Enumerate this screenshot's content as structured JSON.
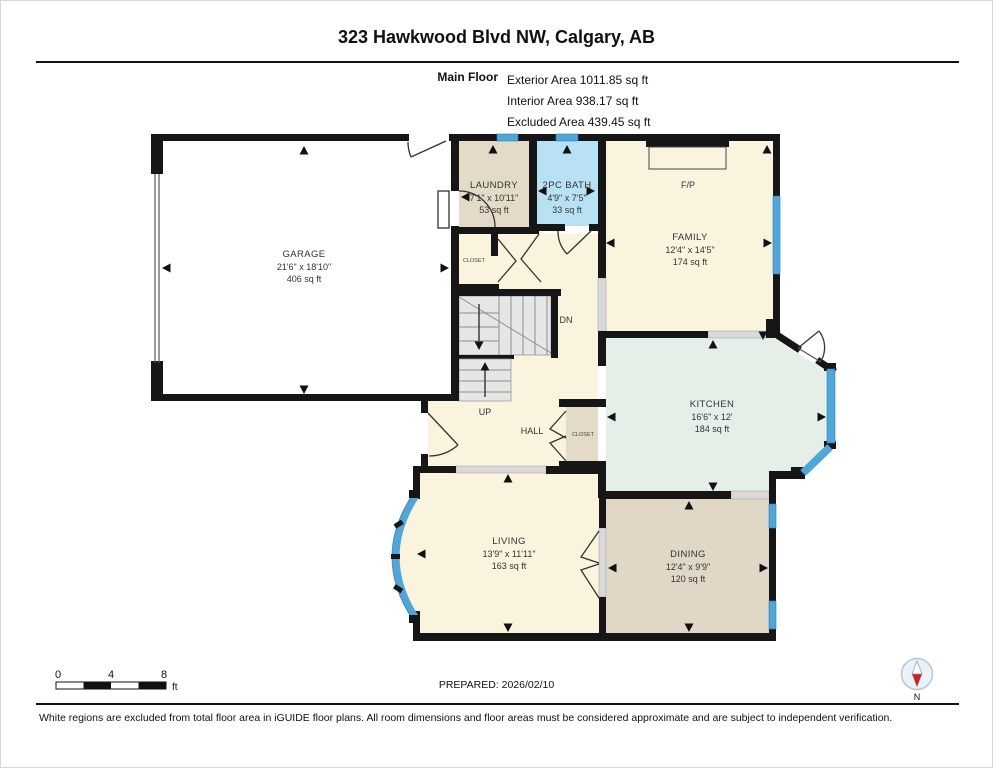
{
  "header": {
    "title": "323 Hawkwood Blvd NW, Calgary, AB",
    "floor_label": "Main Floor",
    "areas": [
      "Exterior Area 1011.85 sq ft",
      "Interior Area 938.17 sq ft",
      "Excluded Area 439.45 sq ft"
    ]
  },
  "rooms": {
    "garage": {
      "name": "GARAGE",
      "dims": "21'6\" x 18'10\"",
      "area": "406 sq ft"
    },
    "laundry": {
      "name": "LAUNDRY",
      "dims": "7'1\" x 10'11\"",
      "area": "53 sq ft"
    },
    "bath": {
      "name": "2PC BATH",
      "dims": "4'9\" x 7'5\"",
      "area": "33 sq ft"
    },
    "family": {
      "name": "FAMILY",
      "dims": "12'4\" x 14'5\"",
      "area": "174 sq ft"
    },
    "kitchen": {
      "name": "KITCHEN",
      "dims": "16'6\" x 12'",
      "area": "184 sq ft"
    },
    "living": {
      "name": "LIVING",
      "dims": "13'9\" x 11'11\"",
      "area": "163 sq ft"
    },
    "dining": {
      "name": "DINING",
      "dims": "12'4\" x 9'9\"",
      "area": "120 sq ft"
    }
  },
  "labels": {
    "fireplace": "F/P",
    "down": "DN",
    "up": "UP",
    "hall": "HALL",
    "closet_laundry": "CLOSET",
    "closet_hall": "CLOSET",
    "north": "N"
  },
  "footer": {
    "scale_ticks": [
      "0",
      "4",
      "8"
    ],
    "scale_unit": "ft",
    "prepared": "PREPARED: 2026/02/10",
    "disclaimer": "White regions are excluded from total floor area in iGUIDE floor plans. All room dimensions and floor areas must be considered approximate and are subject to independent verification."
  },
  "colors": {
    "wall": "#161616",
    "cream_room": "#faf3dd",
    "tan_room": "#e4dac8",
    "bath_blue": "#b8e2f3",
    "kitchen_green": "#e5efe8",
    "window_blue": "#4fa6d9",
    "stair_gray": "#e6e6e6",
    "sill_gray": "#d9d9d9",
    "compass_red": "#cc2222"
  }
}
